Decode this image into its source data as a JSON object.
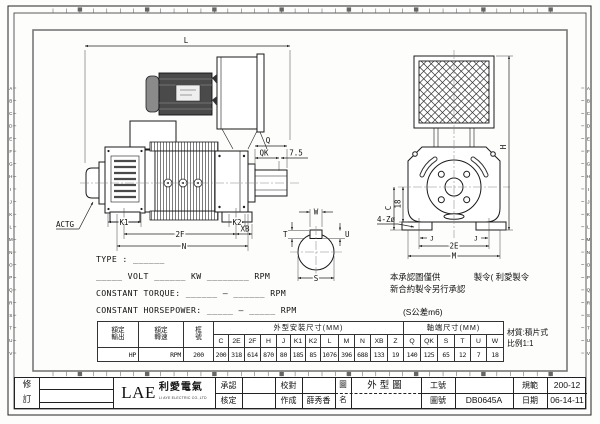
{
  "ruler": {
    "side_letters": [
      "A",
      "B",
      "C",
      "D",
      "E",
      "F",
      "G",
      "H",
      "I",
      "J",
      "K",
      "L",
      "M",
      "N",
      "O",
      "P",
      "Q",
      "R",
      "S",
      "T",
      "U",
      "V"
    ]
  },
  "side_view": {
    "dim_L": "L",
    "dim_Q": "Q",
    "dim_QK": "QK",
    "dim_75": "7.5",
    "dim_K1": "K1",
    "dim_K2": "K2",
    "dim_2F": "2F",
    "dim_XB": "XB",
    "dim_N": "N",
    "label_actg": "ACTG"
  },
  "shaft_view": {
    "dim_W": "W",
    "dim_T": "T",
    "dim_U": "U",
    "dim_S": "S"
  },
  "end_view": {
    "dim_H": "H",
    "dim_C": "C",
    "dim_18": "18",
    "dim_holes": "4-Zø",
    "dim_J_left": "J",
    "dim_J_right": "J",
    "dim_2E": "2E",
    "dim_M": "M"
  },
  "spec": {
    "type_line": "TYPE : ______",
    "volt_line": "_____ VOLT ______ KW ________ RPM",
    "torque_line": "CONSTANT TORQUE: ______ — ______ RPM",
    "hp_line": "CONSTANT HORSEPOWER: _____ — _____ RPM"
  },
  "notes": {
    "line1": "本承認圖僅供　　　　製令( 利愛製令",
    "line2": "新合約製令另行承認",
    "tolerance": "(S公差m6)"
  },
  "table": {
    "rated_output_l1": "額定",
    "rated_output_l2": "輸出",
    "rated_speed_l1": "額定",
    "rated_speed_l2": "轉速",
    "frame_l1": "框",
    "frame_l2": "號",
    "outline_header": "外型安裝尺寸(MM)",
    "shaft_header": "軸端尺寸(MM)",
    "dim_headers": [
      "C",
      "2E",
      "2F",
      "H",
      "J",
      "K1",
      "K2",
      "L",
      "M",
      "N",
      "XB",
      "Z",
      "Q",
      "QK",
      "S",
      "T",
      "U",
      "W"
    ],
    "output_value": "HP",
    "speed_value": "RPM",
    "frame_value": "200",
    "dim_values": [
      "200",
      "318",
      "614",
      "870",
      "80",
      "185",
      "85",
      "1076",
      "396",
      "688",
      "133",
      "19",
      "140",
      "125",
      "65",
      "12",
      "7",
      "18"
    ],
    "material": "材質:積片式",
    "scale": "比例1:1"
  },
  "title_block": {
    "revision_l1": "修",
    "revision_l2": "訂",
    "logo_main": "LAE",
    "logo_cn": "利愛電氣",
    "logo_sub": "LI AYE ELECTRIC CO.,LTD",
    "approve_label": "承認",
    "check_label": "核定",
    "proof_label": "校對",
    "made_label": "作成",
    "made_value": "薛秀香",
    "name_label_l1": "圖",
    "name_label_l2": "名",
    "drawing_name": "外型圖",
    "work_no_label": "工號",
    "drawing_no_label": "圖號",
    "drawing_no_value": "DB0645A",
    "spec_label": "規範",
    "spec_value": "200-12",
    "date_label": "日期",
    "date_value": "06-14-11"
  }
}
